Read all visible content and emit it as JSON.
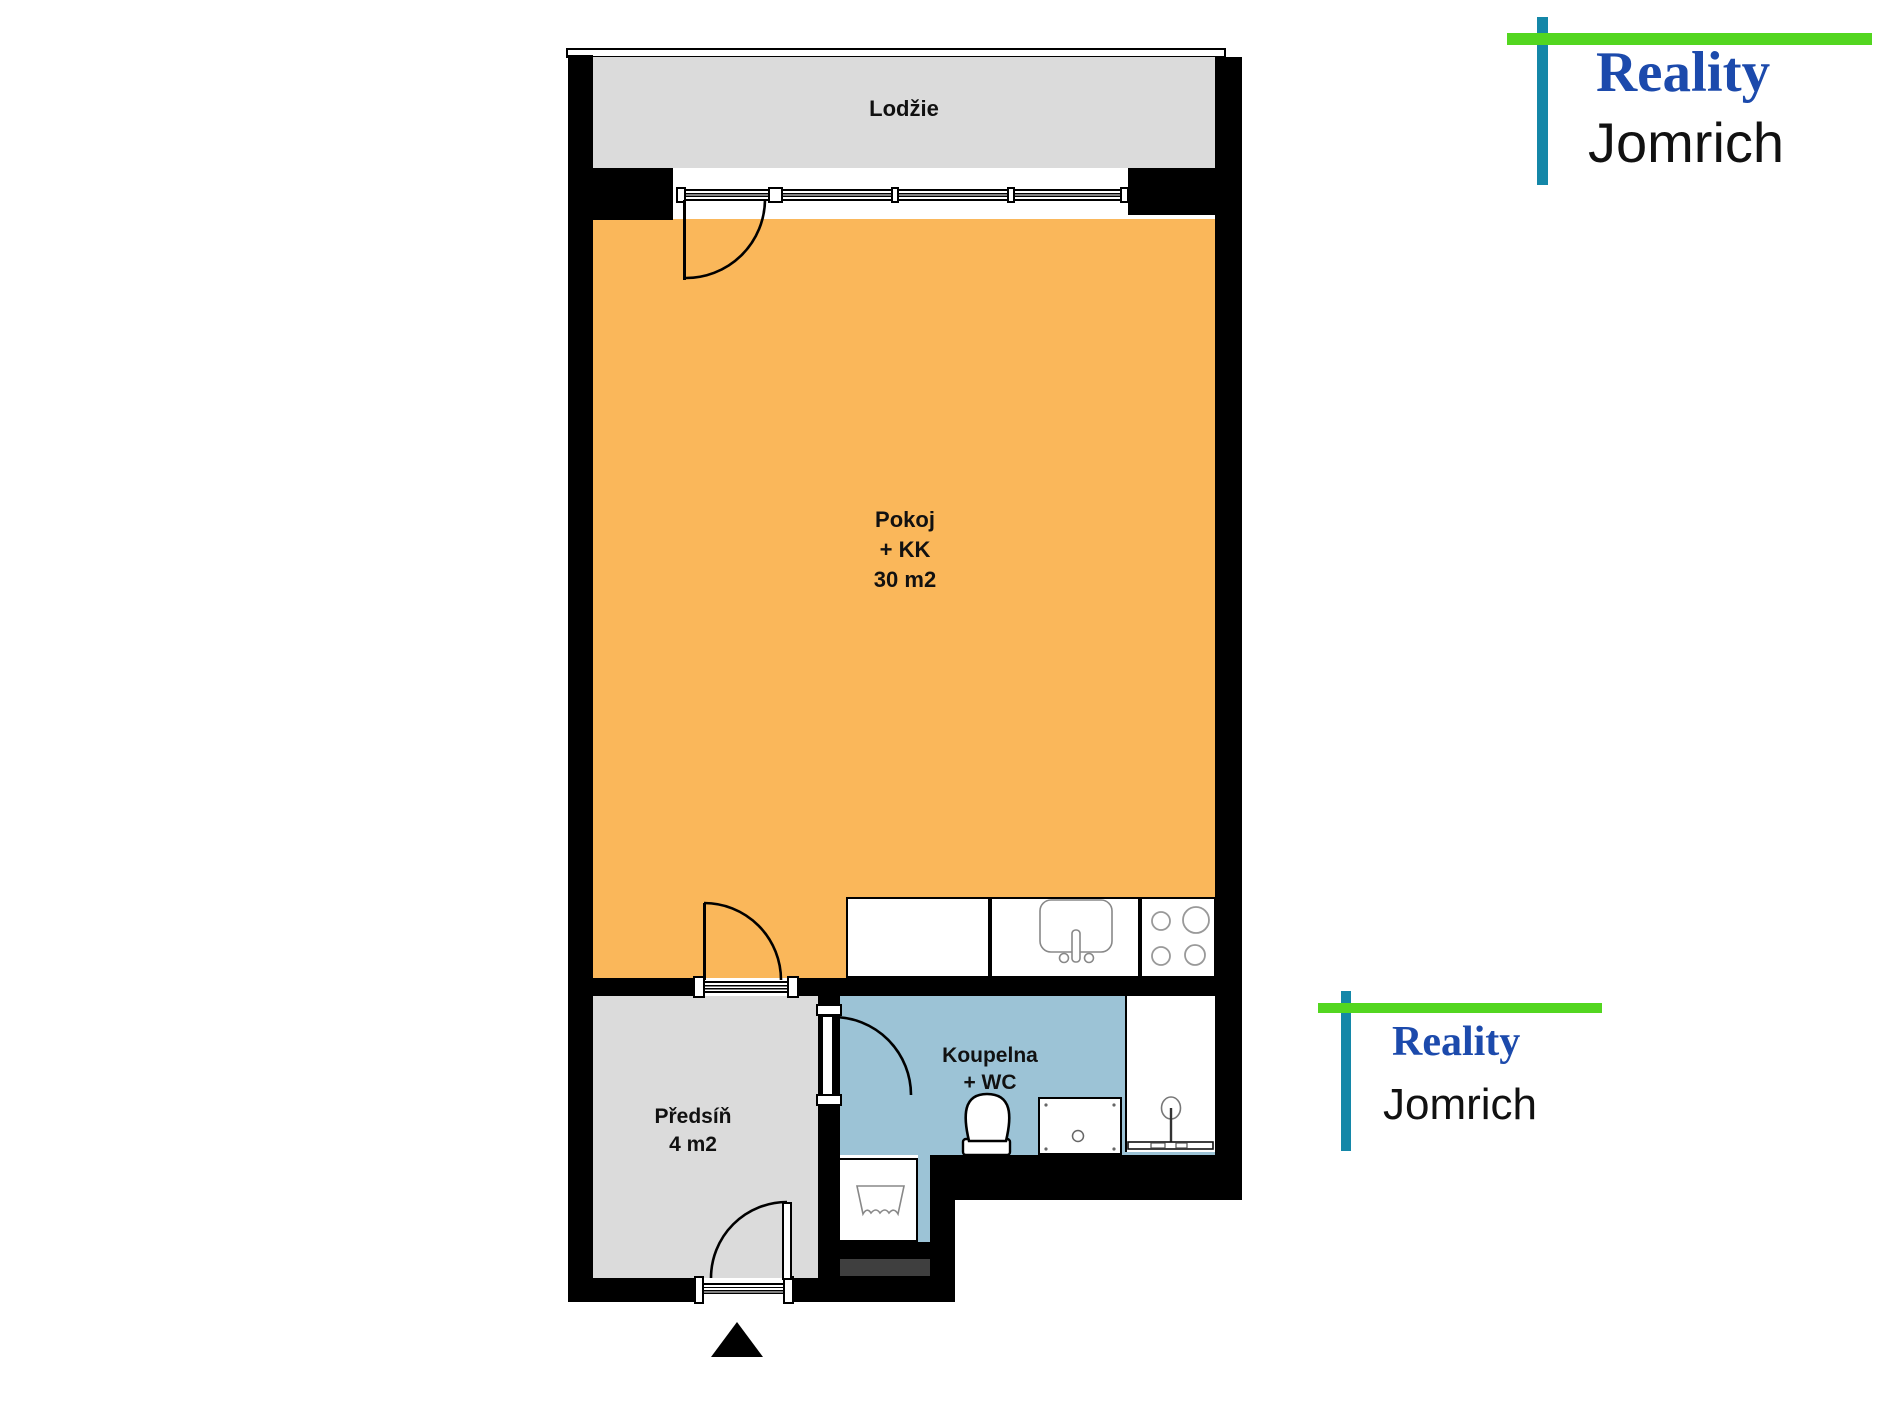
{
  "rooms": {
    "loggia": {
      "label": "Lodžie"
    },
    "pokoj": {
      "lines": [
        "Pokoj",
        "+ KK",
        "30 m2"
      ]
    },
    "koupelna": {
      "lines": [
        "Koupelna",
        "+ WC"
      ]
    },
    "predsin": {
      "lines": [
        "Předsíň",
        "4 m2"
      ]
    }
  },
  "logo": {
    "line1": "Reality",
    "line2": "Jomrich"
  },
  "colors": {
    "orange": "#FAB75A",
    "room_gray": "#DBDBDB",
    "bath_blue": "#9CC3D6",
    "wall": "#000000",
    "dark_bar": "#3F3F3F",
    "logo_green": "#53D620",
    "logo_teal": "#1487A8",
    "logo_blue": "#1C4AAC",
    "label": "#111111"
  }
}
